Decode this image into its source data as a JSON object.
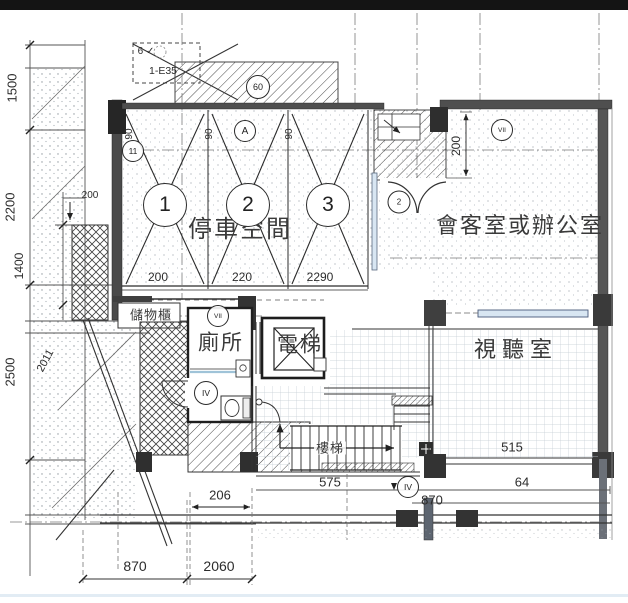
{
  "drawing": {
    "rooms": {
      "parking": "停車空間",
      "office": "會客室或辦公室",
      "toilet": "廁所",
      "elevator": "電梯",
      "av_room": "視聽室",
      "storage": "儲物櫃",
      "stairs": "樓梯"
    },
    "parking": {
      "space_numbers": [
        "1",
        "2",
        "3"
      ],
      "bay_widths": [
        "90",
        "90",
        "90"
      ],
      "dims": [
        "200",
        "220",
        "2290"
      ]
    },
    "left_dims": {
      "d1500": "1500",
      "d2200": "2200",
      "d1400": "1400",
      "d2500": "2500",
      "d2011": "2011",
      "d200": "200"
    },
    "top": {
      "note_check": "6 ✓",
      "note_code": "1-E35",
      "bubble_60": "60",
      "bubble_a": "A",
      "bubble_11": "11"
    },
    "right_dims": {
      "d200": "200"
    },
    "bottom_dims": {
      "d206": "206",
      "d575": "575",
      "d64": "64",
      "d870_right": "870",
      "d515": "515",
      "d870": "870",
      "d2060": "2060"
    },
    "bubbles": {
      "b7_top": "VII",
      "b7_mid": "VII",
      "b4_toilet": "IV",
      "b4_bottom": "IV",
      "door_tag": "2"
    },
    "colors": {
      "paper": "#ffffff",
      "ink": "#2b2b2b",
      "wall": "#4a4a4a",
      "window": "#d8e6f2",
      "topbar": "#141414"
    }
  }
}
